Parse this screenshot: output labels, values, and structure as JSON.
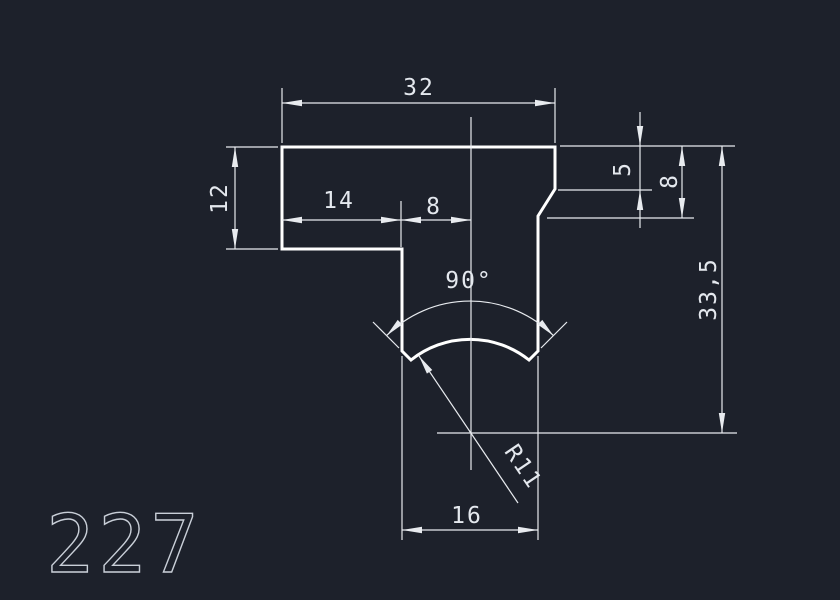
{
  "drawing": {
    "part_number": "227",
    "labels": {
      "top_width": "32",
      "flange_height": "12",
      "flange_to_groove": "14",
      "groove_to_center": "8",
      "chamfer_height": "5",
      "shoulder_height": "8",
      "overall_height": "33,5",
      "groove_angle": "90°",
      "groove_radius": "R11",
      "groove_width": "16"
    },
    "colors": {
      "background": "#1d212b",
      "part_outline": "#ffffff",
      "dimension_lines": "#e8ebef",
      "part_number_text": "#c9cfd8"
    }
  }
}
